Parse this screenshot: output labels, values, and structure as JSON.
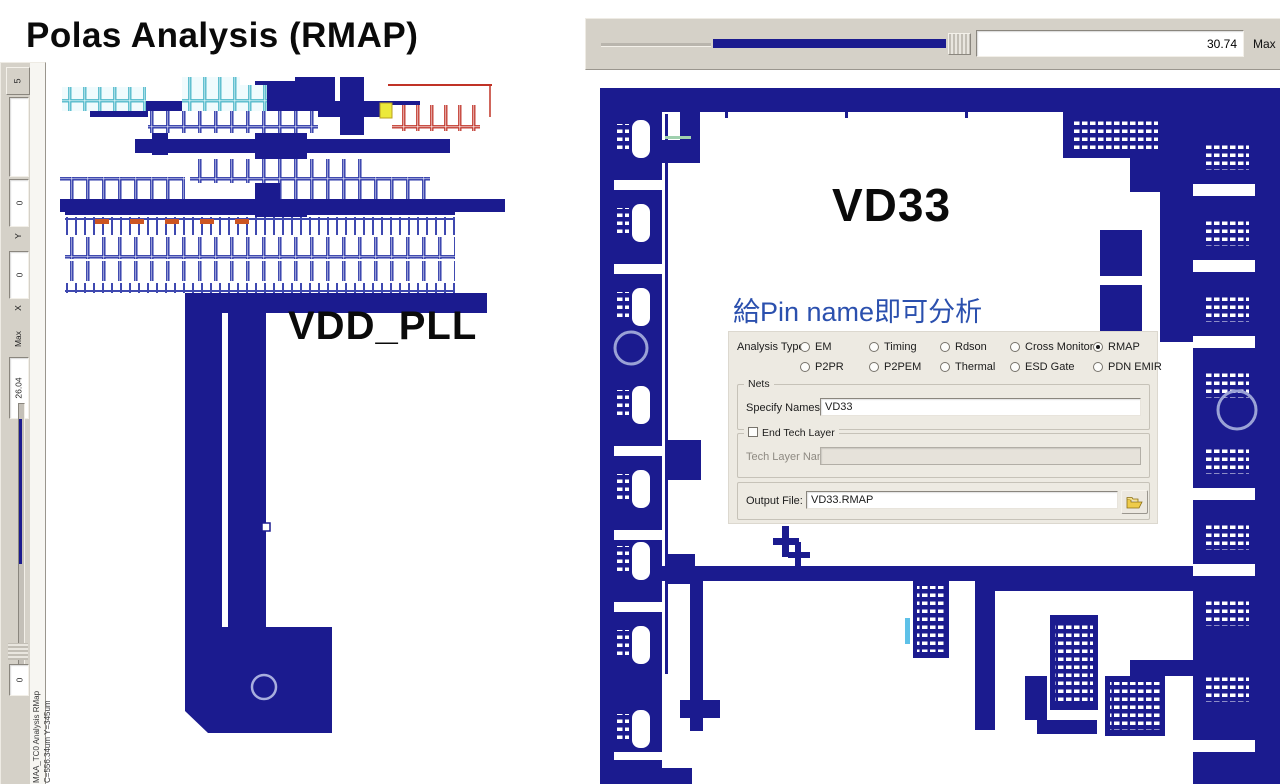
{
  "title": "Polas Analysis (RMAP)",
  "left_viewer": {
    "net_label": "VDD_PLL",
    "toolbar": {
      "fit_button_glyph": "5",
      "y_label": "Y",
      "y_value": "0",
      "x_label": "X",
      "x_value": "0",
      "max_label": "Max",
      "max_value": "26.04",
      "pos_value": "0"
    },
    "status_line1": "MAA_TC0   Analysis RMap",
    "status_line2": "C=556.34um  Y=345um"
  },
  "right_viewer": {
    "net_label": "VD33",
    "annotation": "給Pin name即可分析",
    "toolbar": {
      "max_value": "30.74",
      "max_label": "Max"
    },
    "dialog": {
      "analysis_type_label": "Analysis Type",
      "radios": [
        {
          "label": "EM",
          "selected": false
        },
        {
          "label": "Timing",
          "selected": false
        },
        {
          "label": "Rdson",
          "selected": false
        },
        {
          "label": "Cross Monitor",
          "selected": false
        },
        {
          "label": "RMAP",
          "selected": true
        },
        {
          "label": "P2PR",
          "selected": false
        },
        {
          "label": "P2PEM",
          "selected": false
        },
        {
          "label": "Thermal",
          "selected": false
        },
        {
          "label": "ESD Gate",
          "selected": false
        },
        {
          "label": "PDN EMIR",
          "selected": false
        }
      ],
      "nets_group_label": "Nets",
      "specify_names_label": "Specify Names:",
      "specify_names_value": "VD33",
      "end_tech_layer_label": "End Tech Layer",
      "end_tech_layer_checked": false,
      "tech_layer_name_label": "Tech Layer Name:",
      "tech_layer_name_value": "",
      "output_file_label": "Output File:",
      "output_file_value": "VD33.RMAP"
    }
  },
  "colors": {
    "net_navy": "#1b1b8f",
    "annotation_blue": "#2b50ae",
    "toolbar_bg": "#d5d1c8",
    "dialog_bg": "#edeae2",
    "via_circle": "#9aa2d6"
  }
}
